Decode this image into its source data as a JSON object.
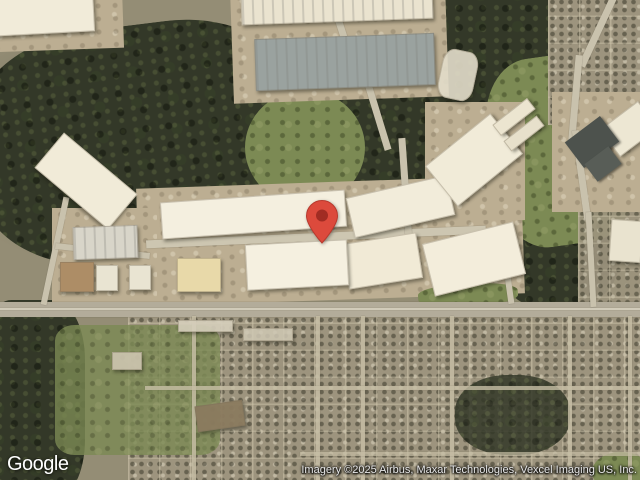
{
  "map": {
    "view_type": "satellite",
    "logo_text": "Google",
    "attribution": "Imagery ©2025 Airbus, Maxar Technologies, Vexcel Imaging US, Inc.",
    "marker": {
      "name": "location-pin",
      "color": "#DC4A3C",
      "inner_color": "#A12C23",
      "outline_color": "#B73A2E",
      "tip_x": 322,
      "tip_y": 244
    },
    "features": {
      "terrain": [
        {
          "name": "forest-west",
          "kind": "forest",
          "x": -25,
          "y": 25,
          "w": 330,
          "h": 235,
          "rot": -7,
          "r": "38%"
        },
        {
          "name": "forest-center",
          "kind": "forest",
          "x": 295,
          "y": 70,
          "w": 210,
          "h": 155,
          "rot": 6,
          "r": "45%"
        },
        {
          "name": "forest-northeast",
          "kind": "forest",
          "x": 425,
          "y": -20,
          "w": 170,
          "h": 130,
          "rot": 0,
          "r": "40%"
        },
        {
          "name": "forest-east",
          "kind": "forest",
          "x": 495,
          "y": 195,
          "w": 125,
          "h": 115,
          "rot": 0,
          "r": "45%"
        },
        {
          "name": "forest-southwest",
          "kind": "forest",
          "x": -20,
          "y": 300,
          "w": 105,
          "h": 200,
          "rot": 0,
          "r": "30%"
        },
        {
          "name": "green-field-east",
          "kind": "green",
          "x": 490,
          "y": 55,
          "w": 140,
          "h": 190,
          "rot": -8,
          "r": "35%"
        },
        {
          "name": "green-center",
          "kind": "green",
          "x": 245,
          "y": 90,
          "w": 120,
          "h": 115,
          "rot": 0,
          "r": "50%"
        },
        {
          "name": "residential-northeast",
          "kind": "residential",
          "x": 548,
          "y": -10,
          "w": 110,
          "h": 135,
          "rot": 0,
          "r": "0"
        },
        {
          "name": "residential-east",
          "kind": "residential",
          "x": 578,
          "y": 170,
          "w": 75,
          "h": 155,
          "rot": 0,
          "r": "0",
          "op": 0.92
        },
        {
          "name": "residential-south",
          "kind": "residential",
          "x": 128,
          "y": 316,
          "w": 525,
          "h": 170,
          "rot": 0,
          "r": "0"
        },
        {
          "name": "park-fields-south",
          "kind": "green",
          "x": 55,
          "y": 325,
          "w": 165,
          "h": 130,
          "rot": 0,
          "r": "12%",
          "op": 0.8
        },
        {
          "name": "forest-south-cluster",
          "kind": "forest",
          "x": 455,
          "y": 375,
          "w": 115,
          "h": 80,
          "rot": 0,
          "r": "45%",
          "op": 0.85
        },
        {
          "name": "green-oval-southeast",
          "kind": "green",
          "x": 592,
          "y": 452,
          "w": 58,
          "h": 40,
          "rot": 0,
          "r": "50%"
        },
        {
          "name": "ground-north",
          "kind": "ground",
          "x": 232,
          "y": -12,
          "w": 215,
          "h": 112,
          "rot": -2
        },
        {
          "name": "ground-northwest",
          "kind": "ground",
          "x": -12,
          "y": -12,
          "w": 135,
          "h": 62,
          "rot": -2
        },
        {
          "name": "ground-business-park",
          "kind": "ground",
          "x": 138,
          "y": 182,
          "w": 385,
          "h": 118,
          "rot": -2
        },
        {
          "name": "ground-west-strip",
          "kind": "ground",
          "x": 52,
          "y": 208,
          "w": 105,
          "h": 98,
          "rot": 0
        },
        {
          "name": "ground-east-cluster",
          "kind": "ground",
          "x": 425,
          "y": 102,
          "w": 100,
          "h": 118,
          "rot": 0
        },
        {
          "name": "ground-northeast-cluster",
          "kind": "ground",
          "x": 552,
          "y": 92,
          "w": 92,
          "h": 120,
          "rot": 0
        },
        {
          "name": "green-median",
          "kind": "green",
          "x": 418,
          "y": 284,
          "w": 100,
          "h": 22,
          "rot": -3,
          "r": "40%"
        }
      ],
      "roads": [
        {
          "name": "highway",
          "kind": "road",
          "x": -8,
          "y": 302,
          "w": 656,
          "h": 15,
          "color": "#b3ac9a"
        },
        {
          "name": "highway-lane-line",
          "kind": "road",
          "x": -8,
          "y": 308,
          "w": 656,
          "h": 2,
          "color": "#d9d3c1",
          "op": 0.8
        },
        {
          "name": "business-park-road",
          "kind": "road",
          "x": 146,
          "y": 233,
          "w": 340,
          "h": 8,
          "rot": -2.5,
          "color": "#cdc6b1"
        },
        {
          "name": "north-road-1",
          "kind": "road",
          "x": 338,
          "y": -8,
          "w": 7,
          "h": 75,
          "rot": -18,
          "color": "#c9c2ad"
        },
        {
          "name": "north-road-2",
          "kind": "road",
          "x": 370,
          "y": 52,
          "w": 7,
          "h": 100,
          "rot": -17,
          "color": "#c9c2ad"
        },
        {
          "name": "north-road-3",
          "kind": "road",
          "x": 402,
          "y": 138,
          "w": 7,
          "h": 105,
          "rot": -4,
          "color": "#c9c2ad"
        },
        {
          "name": "east-road-1",
          "kind": "road",
          "x": 595,
          "y": -10,
          "w": 7,
          "h": 80,
          "rot": 25,
          "color": "#c9c2ad"
        },
        {
          "name": "east-road-2",
          "kind": "road",
          "x": 572,
          "y": 55,
          "w": 7,
          "h": 85,
          "rot": 5,
          "color": "#c9c2ad"
        },
        {
          "name": "east-road-3",
          "kind": "road",
          "x": 578,
          "y": 130,
          "w": 7,
          "h": 90,
          "rot": -8,
          "color": "#c9c2ad"
        },
        {
          "name": "east-road-4",
          "kind": "road",
          "x": 588,
          "y": 212,
          "w": 6,
          "h": 95,
          "rot": -3,
          "color": "#c9c2ad"
        },
        {
          "name": "west-road",
          "kind": "road",
          "x": 52,
          "y": 196,
          "w": 6,
          "h": 110,
          "rot": 12,
          "color": "#c9c2ad"
        },
        {
          "name": "west-connector-road",
          "kind": "road",
          "x": 55,
          "y": 248,
          "w": 95,
          "h": 6,
          "rot": 6,
          "color": "#c9c2ad"
        },
        {
          "name": "highway-connector-road",
          "kind": "road",
          "x": 504,
          "y": 240,
          "w": 6,
          "h": 64,
          "rot": -8,
          "color": "#c9c2ad"
        },
        {
          "name": "south-street-v1",
          "kind": "road",
          "x": 192,
          "y": 316,
          "w": 4,
          "h": 164,
          "color": "#c5bda4",
          "op": 0.85
        },
        {
          "name": "south-street-v2",
          "kind": "road",
          "x": 316,
          "y": 316,
          "w": 4,
          "h": 164,
          "color": "#c5bda4",
          "op": 0.85
        },
        {
          "name": "south-street-v3",
          "kind": "road",
          "x": 361,
          "y": 316,
          "w": 4,
          "h": 164,
          "color": "#c5bda4",
          "op": 0.85
        },
        {
          "name": "south-street-v4",
          "kind": "road",
          "x": 450,
          "y": 316,
          "w": 4,
          "h": 164,
          "color": "#c5bda4",
          "op": 0.85
        },
        {
          "name": "south-street-v5",
          "kind": "road",
          "x": 568,
          "y": 316,
          "w": 4,
          "h": 164,
          "color": "#c5bda4",
          "op": 0.85
        },
        {
          "name": "south-street-v6",
          "kind": "road",
          "x": 628,
          "y": 316,
          "w": 4,
          "h": 164,
          "color": "#c5bda4",
          "op": 0.85
        },
        {
          "name": "south-street-h1",
          "kind": "road",
          "x": 145,
          "y": 386,
          "w": 500,
          "h": 3.5,
          "color": "#c5bda4",
          "op": 0.8
        },
        {
          "name": "south-street-h2",
          "kind": "road",
          "x": 300,
          "y": 452,
          "w": 345,
          "h": 3.5,
          "color": "#c5bda4",
          "op": 0.7
        }
      ],
      "buildings": [
        {
          "name": "warehouse-roof-northwest",
          "kind": "building",
          "x": -10,
          "y": -10,
          "w": 104,
          "h": 44,
          "rot": -3,
          "color": "#f1ebd9"
        },
        {
          "name": "warehouse-roof-north-strip",
          "kind": "building-striped",
          "x": 241,
          "y": -12,
          "w": 192,
          "h": 34,
          "rot": -2,
          "color": "#eae3cf"
        },
        {
          "name": "warehouse-roof-gray",
          "kind": "building-striped",
          "x": 255,
          "y": 36,
          "w": 180,
          "h": 52,
          "rot": -2,
          "color": "#9aa29f"
        },
        {
          "name": "warehouse-roof-west-diagonal",
          "kind": "building",
          "x": 38,
          "y": 158,
          "w": 96,
          "h": 46,
          "rot": 40,
          "color": "#f1ebd8"
        },
        {
          "name": "warehouse-roof-row1-west",
          "kind": "building",
          "x": 161,
          "y": 196,
          "w": 185,
          "h": 37,
          "rot": -4,
          "color": "#f4efdf"
        },
        {
          "name": "warehouse-roof-row1-east",
          "kind": "building",
          "x": 349,
          "y": 186,
          "w": 103,
          "h": 41,
          "rot": -13,
          "color": "#f2ecda"
        },
        {
          "name": "warehouse-roof-east-diagonal",
          "kind": "building",
          "x": 432,
          "y": 134,
          "w": 84,
          "h": 52,
          "rot": -39,
          "color": "#f1ebd8"
        },
        {
          "name": "warehouse-small-east-1",
          "kind": "building",
          "x": 492,
          "y": 110,
          "w": 44,
          "h": 14,
          "rot": -38,
          "color": "#ece5d0"
        },
        {
          "name": "warehouse-small-east-2",
          "kind": "building",
          "x": 503,
          "y": 127,
          "w": 42,
          "h": 13,
          "rot": -38,
          "color": "#e7e0cb"
        },
        {
          "name": "warehouse-roof-row2-east",
          "kind": "building",
          "x": 427,
          "y": 232,
          "w": 94,
          "h": 54,
          "rot": -14,
          "color": "#f3eddb"
        },
        {
          "name": "warehouse-roof-row2-mid",
          "kind": "building",
          "x": 345,
          "y": 238,
          "w": 75,
          "h": 46,
          "rot": -9,
          "color": "#f1ead6"
        },
        {
          "name": "warehouse-roof-row2-west",
          "kind": "building",
          "x": 246,
          "y": 242,
          "w": 102,
          "h": 46,
          "rot": -3,
          "color": "#f5f0e0"
        },
        {
          "name": "warehouse-roof-cream",
          "kind": "building",
          "x": 177,
          "y": 258,
          "w": 44,
          "h": 34,
          "rot": 0,
          "color": "#e8d9a9"
        },
        {
          "name": "truck-terminal",
          "kind": "building-striped",
          "x": 73,
          "y": 226,
          "w": 65,
          "h": 33,
          "rot": -2,
          "color": "#d8d5c9"
        },
        {
          "name": "building-tan-west",
          "kind": "building",
          "x": 60,
          "y": 262,
          "w": 34,
          "h": 30,
          "rot": 0,
          "color": "#ad8d66"
        },
        {
          "name": "building-white-pair-1",
          "kind": "building",
          "x": 96,
          "y": 265,
          "w": 22,
          "h": 26,
          "rot": 0,
          "color": "#e9e4d2"
        },
        {
          "name": "building-white-pair-2",
          "kind": "building",
          "x": 129,
          "y": 265,
          "w": 22,
          "h": 25,
          "rot": 0,
          "color": "#e9e4d2"
        },
        {
          "name": "apartment-cluster-north",
          "kind": "building",
          "x": 440,
          "y": 50,
          "w": 36,
          "h": 50,
          "rot": 12,
          "color": "#e3ddca",
          "r": "30%",
          "op": 0.9
        },
        {
          "name": "warehouse-roof-northeast",
          "kind": "building",
          "x": 605,
          "y": 112,
          "w": 48,
          "h": 34,
          "rot": -37,
          "color": "#ede7d3"
        },
        {
          "name": "parking-dark-northeast",
          "kind": "roof-dark",
          "x": 570,
          "y": 126,
          "w": 44,
          "h": 32,
          "rot": -37,
          "color": "#4d524d"
        },
        {
          "name": "dark-roof-east",
          "kind": "roof-dark",
          "x": 588,
          "y": 153,
          "w": 30,
          "h": 22,
          "rot": -37,
          "color": "#585d57"
        },
        {
          "name": "warehouse-roof-far-east",
          "kind": "building",
          "x": 610,
          "y": 220,
          "w": 32,
          "h": 42,
          "rot": 4,
          "color": "#e9e3cf"
        },
        {
          "name": "commercial-strip-south",
          "kind": "building",
          "x": 178,
          "y": 320,
          "w": 55,
          "h": 12,
          "rot": 0,
          "color": "#d6cfbc",
          "op": 0.9
        },
        {
          "name": "commercial-strip-south-2",
          "kind": "building",
          "x": 243,
          "y": 328,
          "w": 50,
          "h": 13,
          "rot": 0,
          "color": "#cfc8b4",
          "op": 0.85
        },
        {
          "name": "apartment-complex-south",
          "kind": "building",
          "x": 196,
          "y": 403,
          "w": 48,
          "h": 26,
          "rot": -8,
          "color": "#8b7b5f",
          "op": 0.95
        },
        {
          "name": "school-building-south",
          "kind": "building",
          "x": 112,
          "y": 352,
          "w": 30,
          "h": 18,
          "rot": 0,
          "color": "#cdc5b0",
          "op": 0.9
        }
      ]
    }
  }
}
